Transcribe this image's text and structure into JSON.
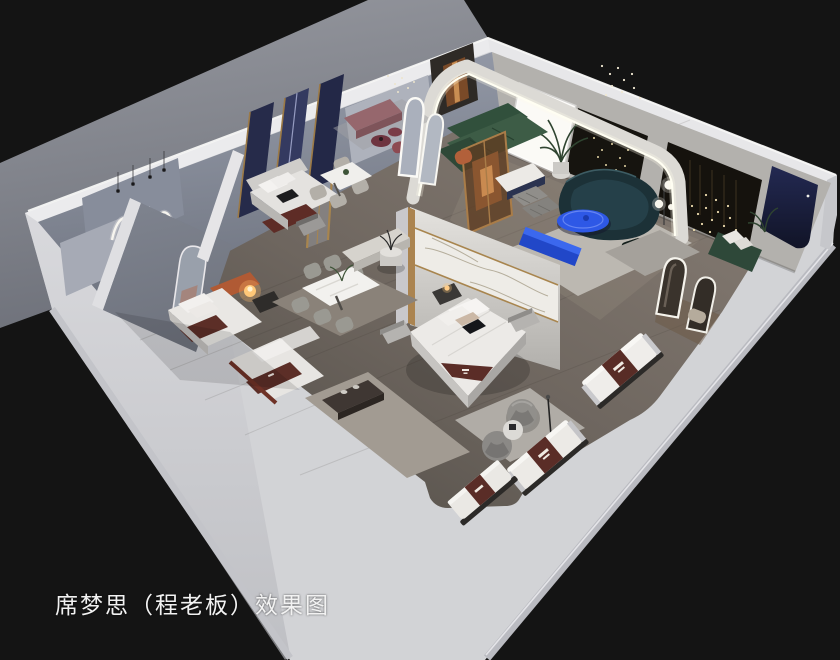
{
  "caption": {
    "text": "席梦思（程老板）效果图"
  },
  "palette": {
    "background": "#141414",
    "ground_plane": "#85888f",
    "podium_white": "#d2d3d6",
    "wall_top": "#ebebed",
    "floor_wood": "#6e665f",
    "inner_wall_blue_gray": "#8e94a2",
    "accent_blue": "#2e58e6",
    "sofa_teal": "#1c3137",
    "sofa_green": "#3a5743",
    "mattress_runner_brown": "#5a2d27",
    "navy_panel": "#1c2140",
    "mauve_bench": "#96676d",
    "orange_accent": "#b05a34",
    "led_glow": "#fffef2",
    "lamp_warm": "#ffc878"
  }
}
